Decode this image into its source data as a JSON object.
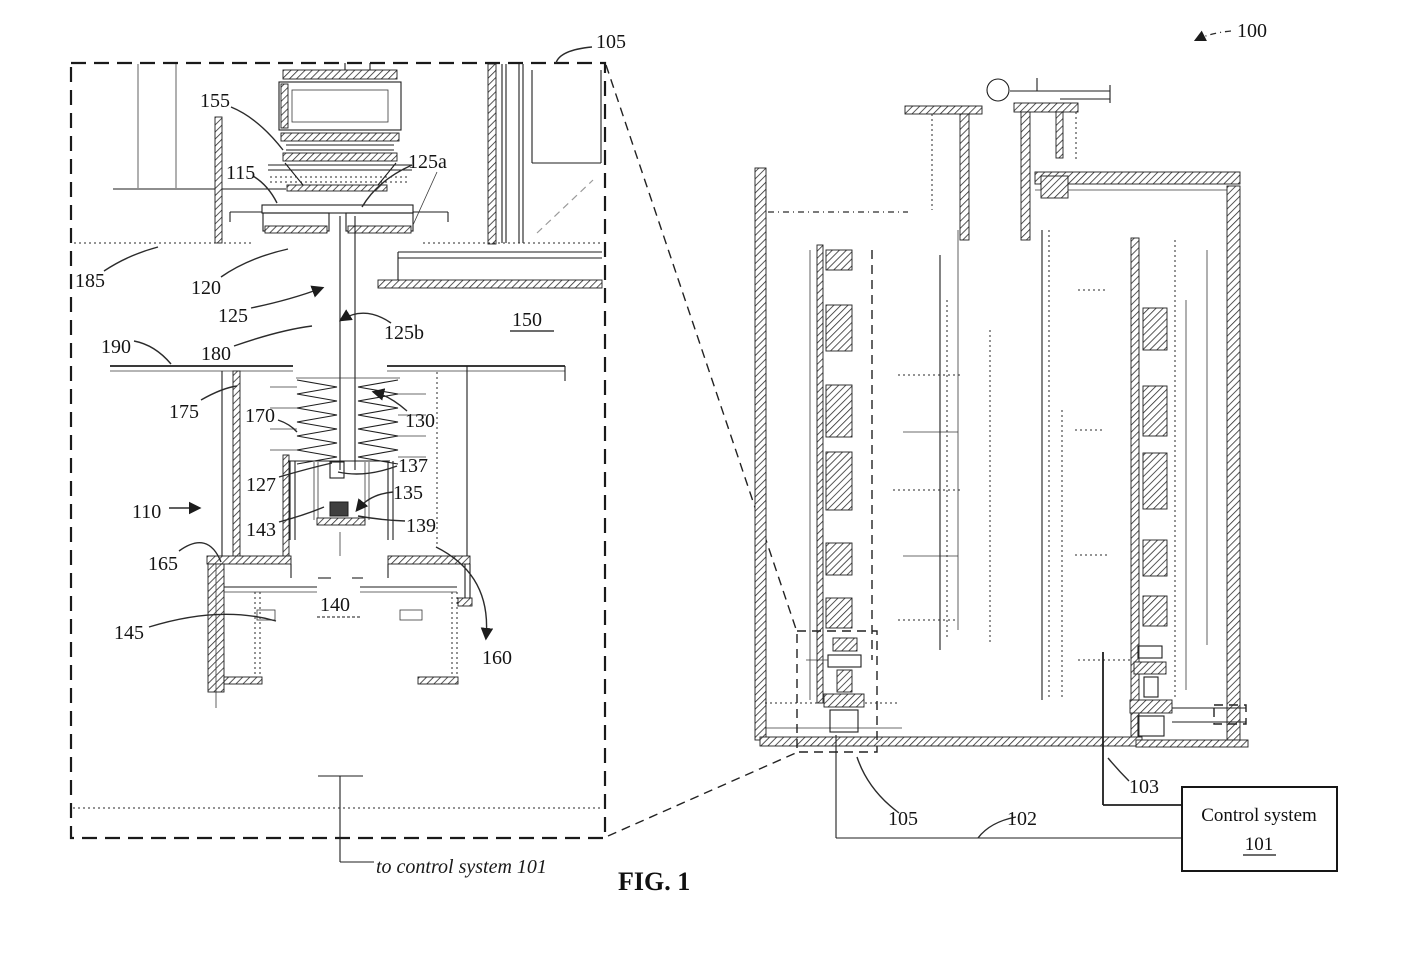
{
  "figure": {
    "caption": "FIG. 1",
    "note_to_control": "to control system 101"
  },
  "detail_view": {
    "refs": {
      "r105": "105",
      "r155": "155",
      "r115": "115",
      "r125a": "125a",
      "r185": "185",
      "r120": "120",
      "r125": "125",
      "r125b": "125b",
      "r150": "150",
      "r190": "190",
      "r180": "180",
      "r175": "175",
      "r170": "170",
      "r130": "130",
      "r137": "137",
      "r127": "127",
      "r135": "135",
      "r110": "110",
      "r143": "143",
      "r139": "139",
      "r165": "165",
      "r140": "140",
      "r145": "145",
      "r160": "160"
    }
  },
  "machine_view": {
    "refs": {
      "r100": "100",
      "r103": "103",
      "r105": "105",
      "r102": "102"
    }
  },
  "control_system": {
    "title": "Control system",
    "ref": "101"
  }
}
